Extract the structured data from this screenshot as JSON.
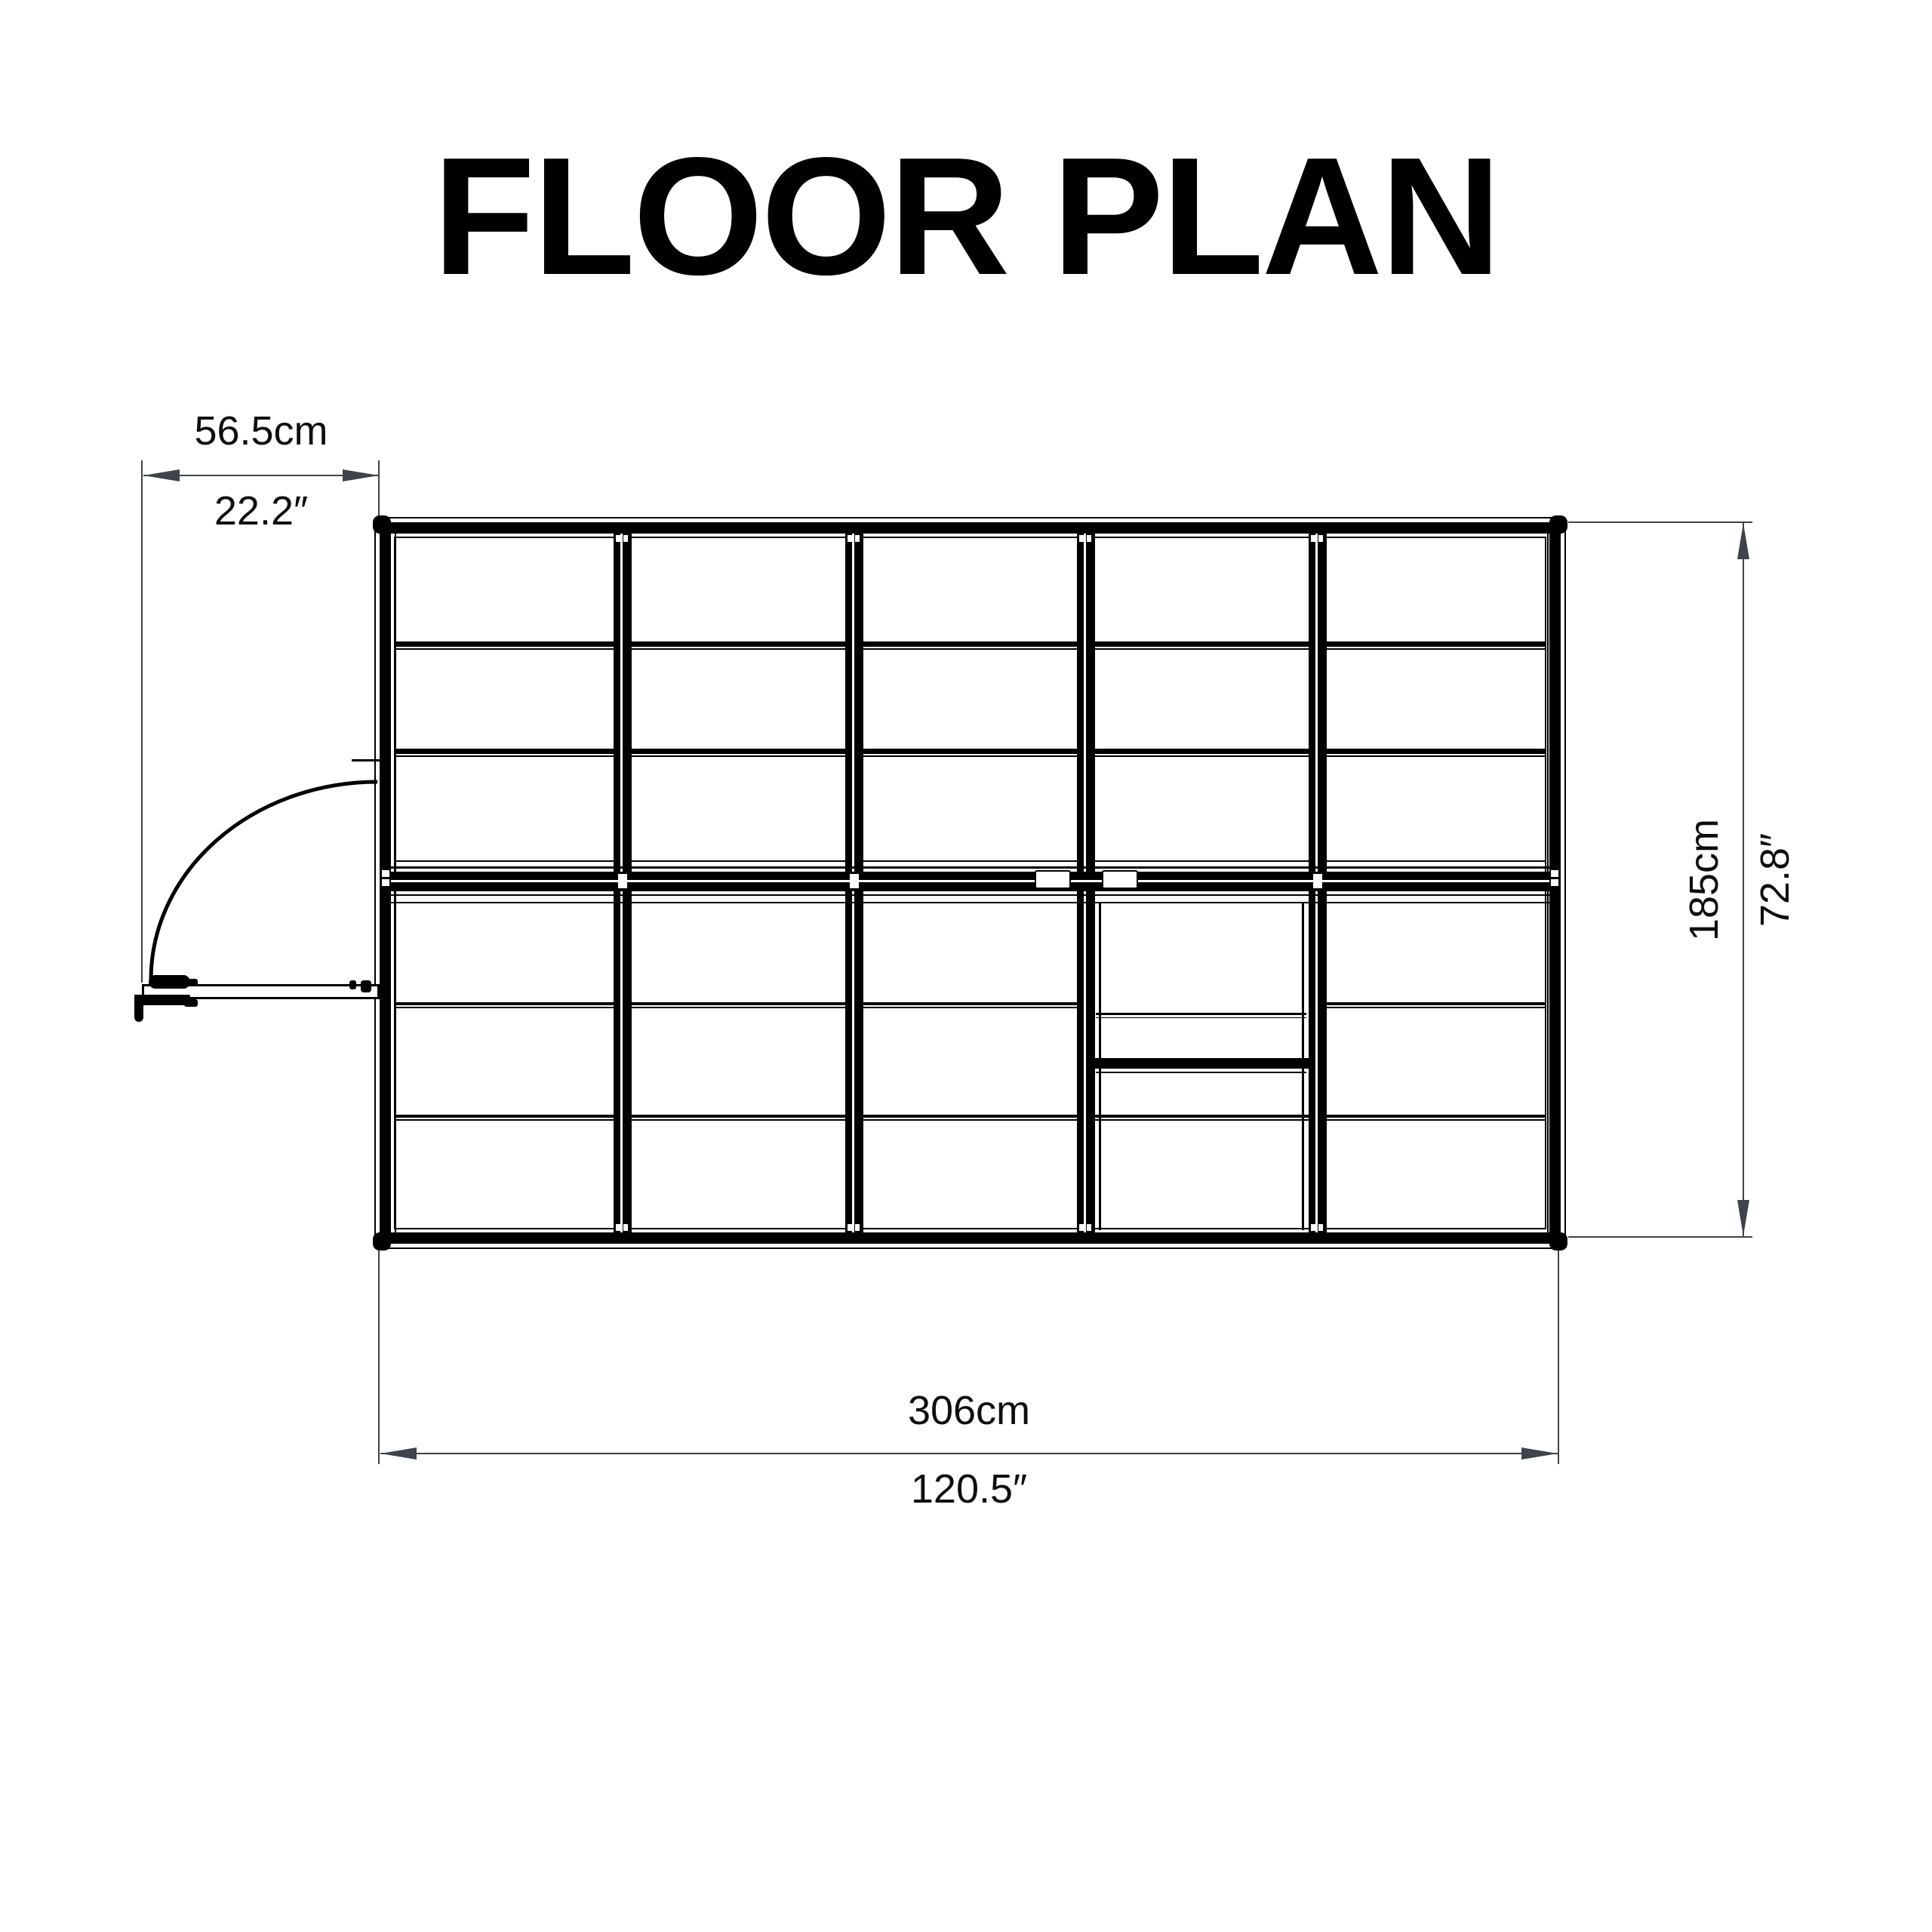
{
  "title": "FLOOR PLAN",
  "dimensions": {
    "door_width": {
      "metric": "56.5cm",
      "imperial": "22.2″"
    },
    "overall_width": {
      "metric": "306cm",
      "imperial": "120.5″"
    },
    "overall_depth": {
      "metric": "185cm",
      "imperial": "72.8″"
    }
  },
  "plan": {
    "bays": 5,
    "panel_rows_per_half": 3,
    "door_swing": "hinged door shown open to the left with quarter-circle swing arc"
  },
  "colors": {
    "linework": "#000000",
    "dimension_lines": "#3e4449",
    "label_text": "#0c0e10",
    "background": "#ffffff"
  }
}
